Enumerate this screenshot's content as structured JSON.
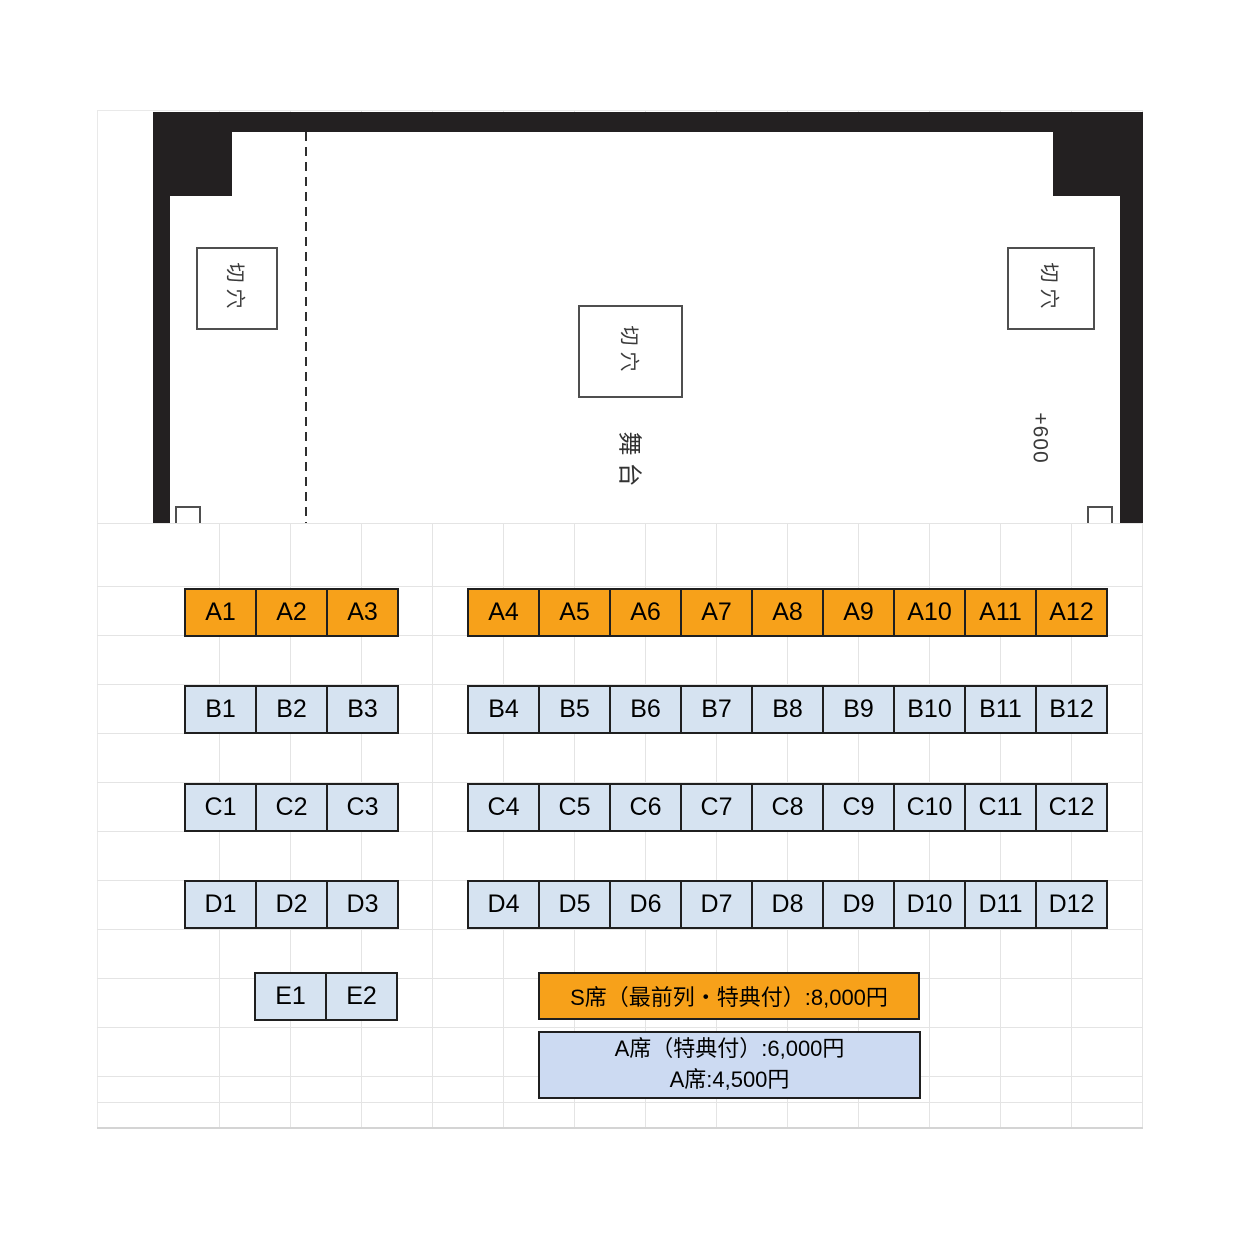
{
  "stage": {
    "trapdoor_labels": [
      "切穴",
      "切穴",
      "切穴"
    ],
    "stage_label": "舞台",
    "elevation_label": "+600"
  },
  "seating": {
    "rows": [
      {
        "row": "A",
        "seat_class": "s",
        "left": [
          "A1",
          "A2",
          "A3"
        ],
        "right": [
          "A4",
          "A5",
          "A6",
          "A7",
          "A8",
          "A9",
          "A10",
          "A11",
          "A12"
        ]
      },
      {
        "row": "B",
        "seat_class": "a",
        "left": [
          "B1",
          "B2",
          "B3"
        ],
        "right": [
          "B4",
          "B5",
          "B6",
          "B7",
          "B8",
          "B9",
          "B10",
          "B11",
          "B12"
        ]
      },
      {
        "row": "C",
        "seat_class": "a",
        "left": [
          "C1",
          "C2",
          "C3"
        ],
        "right": [
          "C4",
          "C5",
          "C6",
          "C7",
          "C8",
          "C9",
          "C10",
          "C11",
          "C12"
        ]
      },
      {
        "row": "D",
        "seat_class": "a",
        "left": [
          "D1",
          "D2",
          "D3"
        ],
        "right": [
          "D4",
          "D5",
          "D6",
          "D7",
          "D8",
          "D9",
          "D10",
          "D11",
          "D12"
        ]
      },
      {
        "row": "E",
        "seat_class": "a",
        "left": [
          "E1",
          "E2"
        ],
        "right": []
      }
    ]
  },
  "legend": {
    "s_seat_label": "S席（最前列・特典付）:8,000円",
    "a_seat_lines": [
      "A席（特典付）:6,000円",
      "A席:4,500円"
    ]
  },
  "colors": {
    "s_seat_fill": "#F7A11A",
    "a_seat_fill": "#D6E3F1",
    "a_legend_fill": "#CCDAF2",
    "wall_black": "#232021"
  }
}
